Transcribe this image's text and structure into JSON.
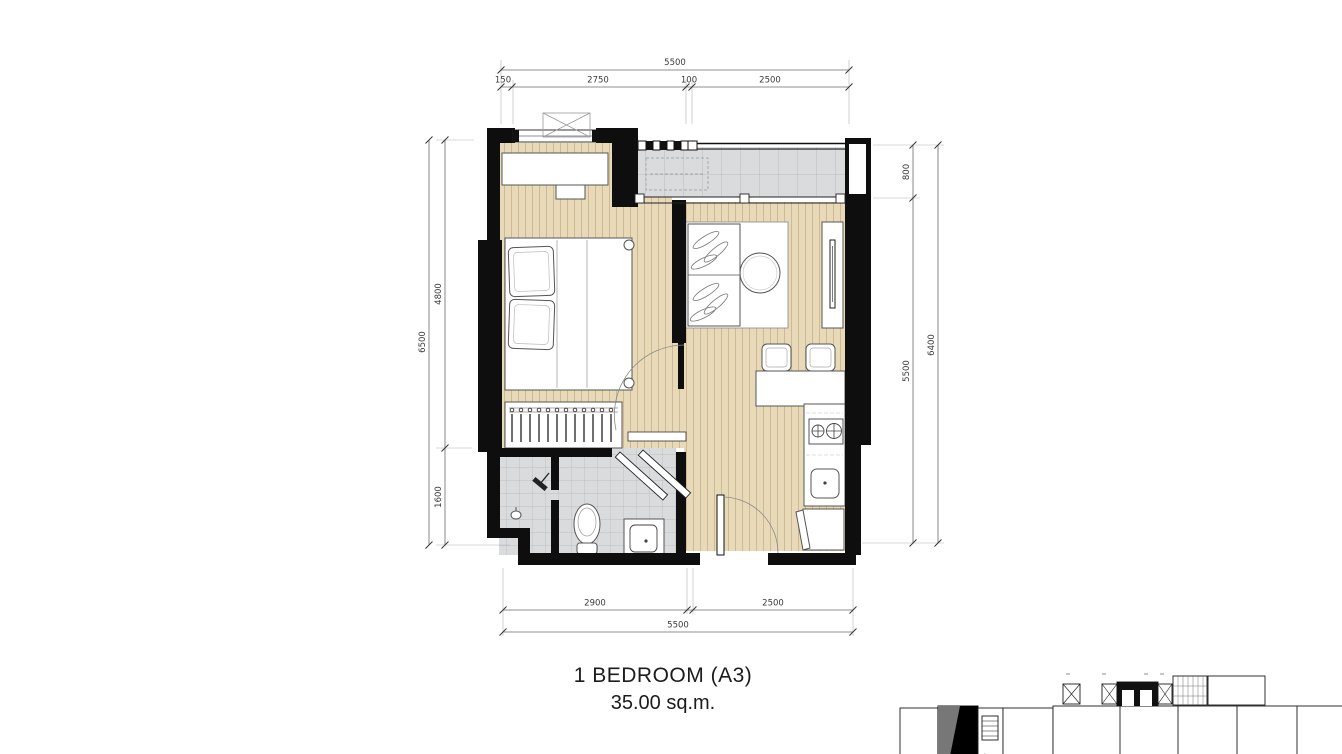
{
  "title": {
    "name": "1 BEDROOM (A3)",
    "area": "35.00 sq.m."
  },
  "dimensions": {
    "top": {
      "overall": "5500",
      "seg1": "150",
      "seg2": "2750",
      "seg3": "100",
      "seg4": "2500"
    },
    "bottom": {
      "overall": "5500",
      "seg1": "2900",
      "seg2": "2500"
    },
    "left": {
      "overall": "6500",
      "seg1": "4800",
      "seg2": "1600"
    },
    "right": {
      "overall": "6400",
      "seg1": "800",
      "seg2": "5500"
    }
  },
  "colors": {
    "wall": "#0e0e0e",
    "wood_floor": "#e8dab9",
    "wood_line": "#cdb992",
    "tile_floor": "#d9dbdd",
    "tile_line": "#b2b6b8",
    "dim_text": "#3a3a3a"
  }
}
